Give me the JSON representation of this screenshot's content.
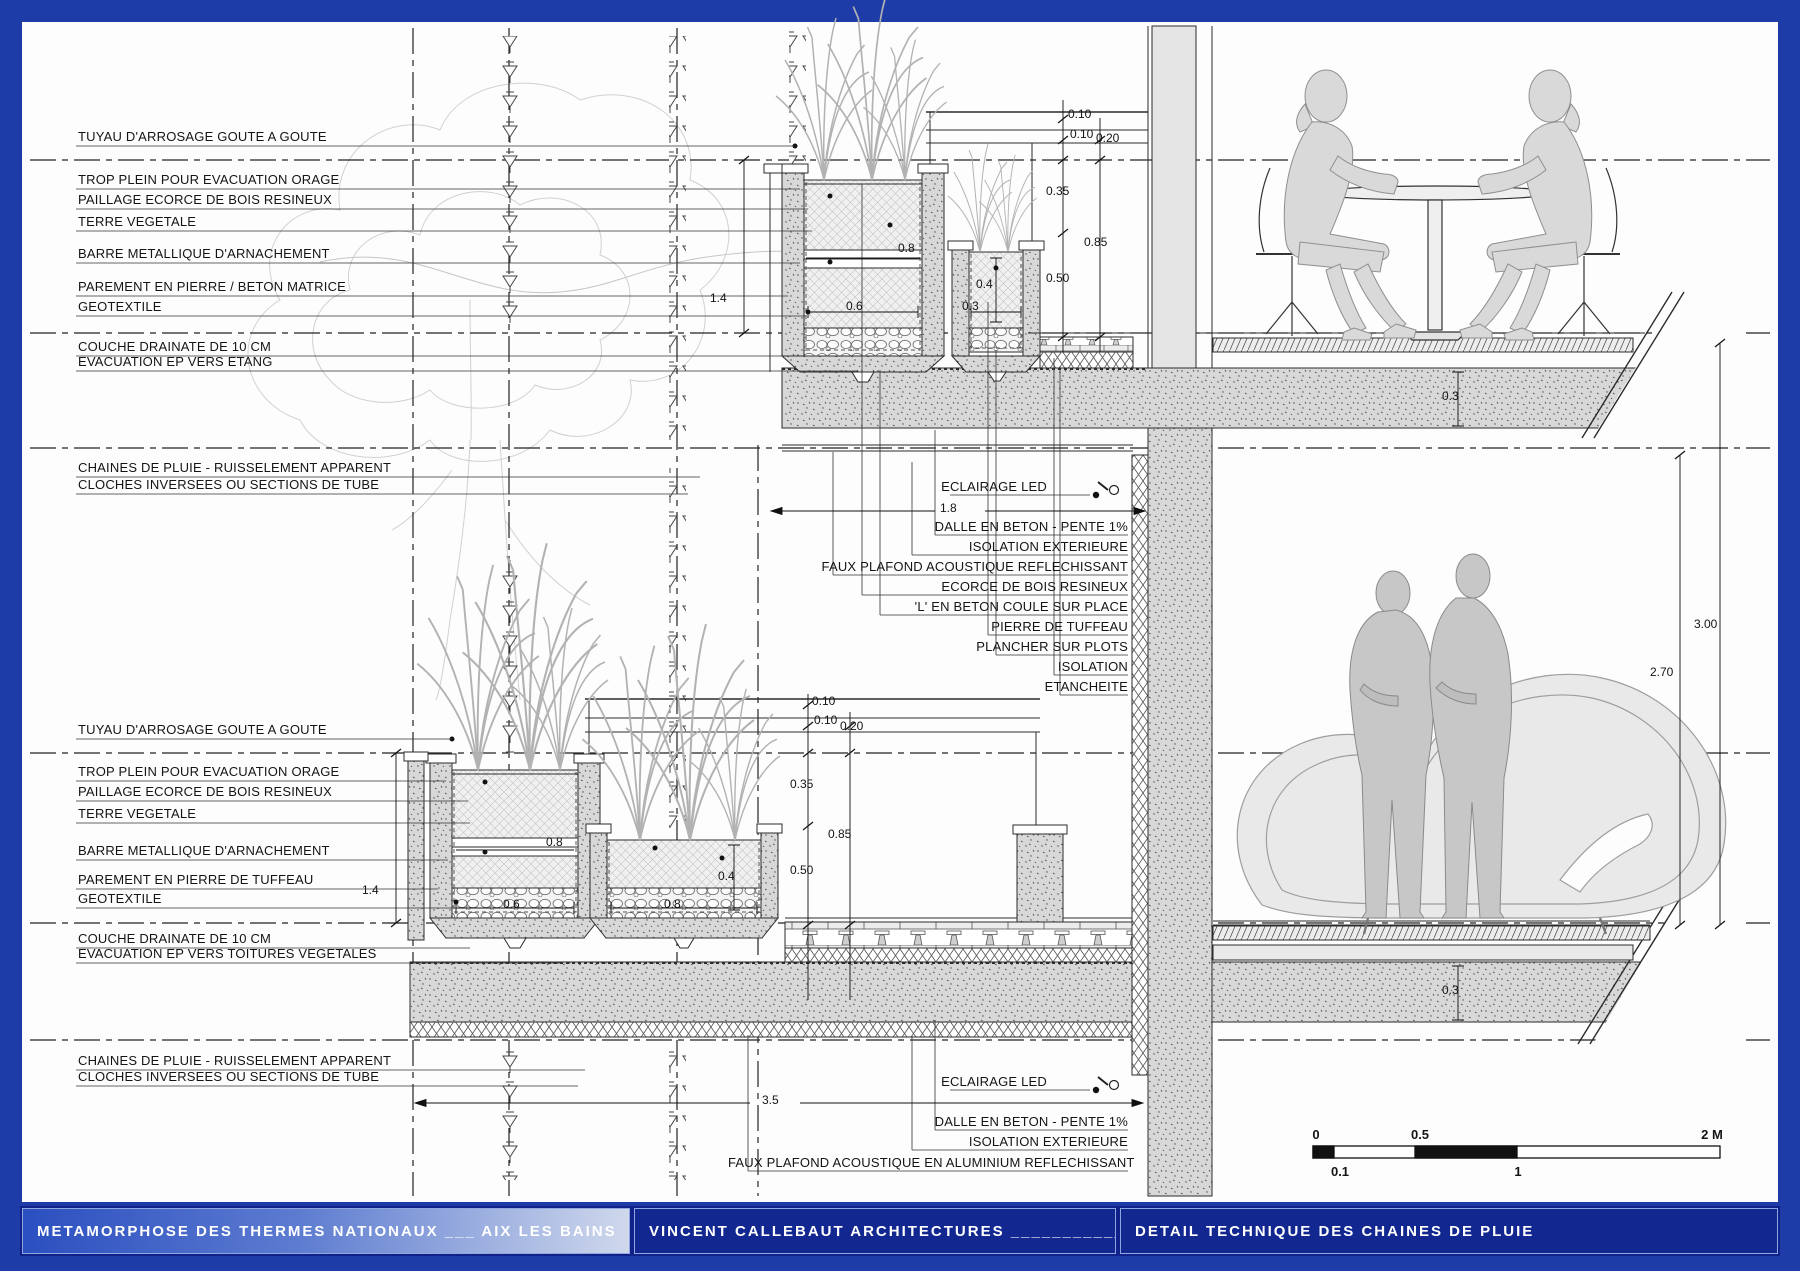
{
  "title_bar": {
    "project": "METAMORPHOSE DES THERMES NATIONAUX ___ AIX LES BAINS",
    "firm": "VINCENT CALLEBAUT ARCHITECTURES ____________ PARIS",
    "sheet": "DETAIL TECHNIQUE DES CHAINES DE PLUIE"
  },
  "labels_upper_left": [
    "TUYAU D'ARROSAGE GOUTE A GOUTE",
    "TROP PLEIN POUR EVACUATION ORAGE",
    "PAILLAGE ECORCE DE BOIS RESINEUX",
    "TERRE VEGETALE",
    "BARRE METALLIQUE D'ARNACHEMENT",
    "PAREMENT EN PIERRE / BETON MATRICE",
    "GEOTEXTILE",
    "COUCHE DRAINATE DE 10 CM",
    "EVACUATION EP VERS ETANG",
    "CHAINES DE PLUIE - RUISSELEMENT APPARENT",
    "CLOCHES INVERSEES OU SECTIONS DE TUBE"
  ],
  "labels_lower_left": [
    "TUYAU D'ARROSAGE GOUTE A GOUTE",
    "TROP PLEIN POUR EVACUATION ORAGE",
    "PAILLAGE ECORCE DE BOIS RESINEUX",
    "TERRE VEGETALE",
    "BARRE METALLIQUE D'ARNACHEMENT",
    "PAREMENT EN PIERRE DE TUFFEAU",
    "GEOTEXTILE",
    "COUCHE DRAINATE DE 10 CM",
    "EVACUATION EP VERS TOITURES VEGETALES",
    "CHAINES DE PLUIE - RUISSELEMENT APPARENT",
    "CLOCHES INVERSEES OU SECTIONS DE TUBE"
  ],
  "labels_upper_right": [
    "ECLAIRAGE LED",
    "DALLE EN BETON - PENTE 1%",
    "ISOLATION EXTERIEURE",
    "FAUX PLAFOND ACOUSTIQUE REFLECHISSANT",
    "ECORCE DE BOIS RESINEUX",
    "'L' EN BETON COULE SUR PLACE",
    "PIERRE DE TUFFEAU",
    "PLANCHER SUR PLOTS",
    "ISOLATION",
    "ETANCHEITE"
  ],
  "labels_lower_right": [
    "ECLAIRAGE LED",
    "DALLE EN BETON - PENTE 1%",
    "ISOLATION EXTERIEURE",
    "FAUX PLAFOND ACOUSTIQUE EN ALUMINIUM REFLECHISSANT"
  ],
  "dimensions": {
    "upper": {
      "rail_gap1": "0.10",
      "rail_gap2": "0.10",
      "rail_total": "0.20",
      "planter_top": "0.35",
      "parapet": "0.85",
      "planter_bottom": "0.50",
      "band_width": "0.8",
      "small_depth": "0.4",
      "big_width": "0.6",
      "small_width": "0.3",
      "depth_total": "1.4",
      "ceiling_span": "1.8",
      "slab": "0.3"
    },
    "lower": {
      "rail_gap1": "0.10",
      "rail_gap2": "0.10",
      "rail_total": "0.20",
      "planter_top": "0.35",
      "parapet": "0.85",
      "planter_bottom": "0.50",
      "band_width": "0.8",
      "big_width": "0.6",
      "second_width": "0.8",
      "second_depth": "0.4",
      "depth_total": "1.4",
      "ceiling_span": "3.5",
      "slab": "0.3"
    },
    "heights": {
      "floor_to_floor": "3.00",
      "clear_height": "2.70"
    }
  },
  "scale_bar": {
    "start": "0",
    "mid": "0.5",
    "end": "2 M",
    "sub1": "0.1",
    "sub2": "1"
  }
}
